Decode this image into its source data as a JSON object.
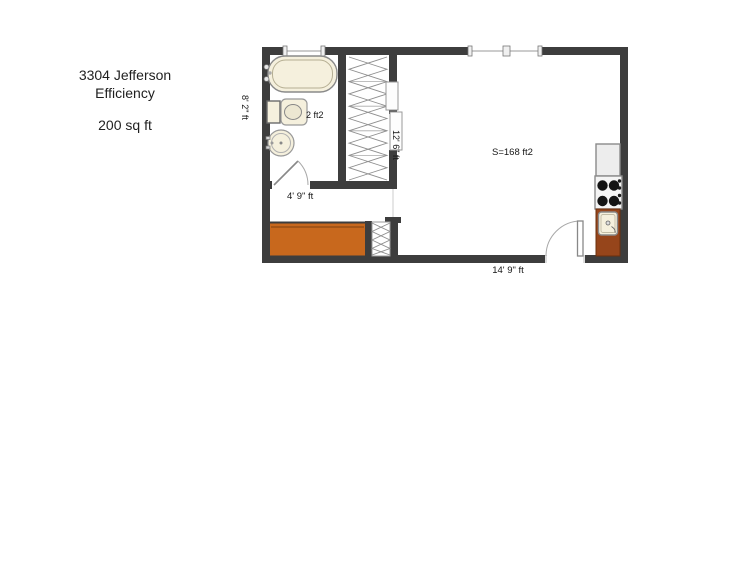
{
  "title": {
    "line1": "3304 Jefferson",
    "line2": "Efficiency",
    "line3": "200 sq ft"
  },
  "floorplan": {
    "labels": {
      "main_room_area": "S=168 ft2",
      "toilet_area": "2 ft2",
      "bathroom_width": "4' 9\" ft",
      "overall_width": "14' 9\" ft",
      "left_height": "8' 2\" ft",
      "closet_height": "12' 6\" ft"
    },
    "colors": {
      "wall": "#3d3d3d",
      "fixture_cream": "#f5f0dd",
      "counter_orange": "#c8681d",
      "counter_brown": "#96451b",
      "appliance_gray": "#ededed",
      "stove_white": "#f4f4f4",
      "outline_gray": "#8a8a8a"
    },
    "fixtures": [
      "bathtub",
      "toilet",
      "bathroom-sink",
      "closet",
      "sliding-doors",
      "radiator",
      "entry-counter",
      "refrigerator",
      "stove",
      "kitchen-sink",
      "entry-door",
      "bathroom-door",
      "windows"
    ]
  }
}
